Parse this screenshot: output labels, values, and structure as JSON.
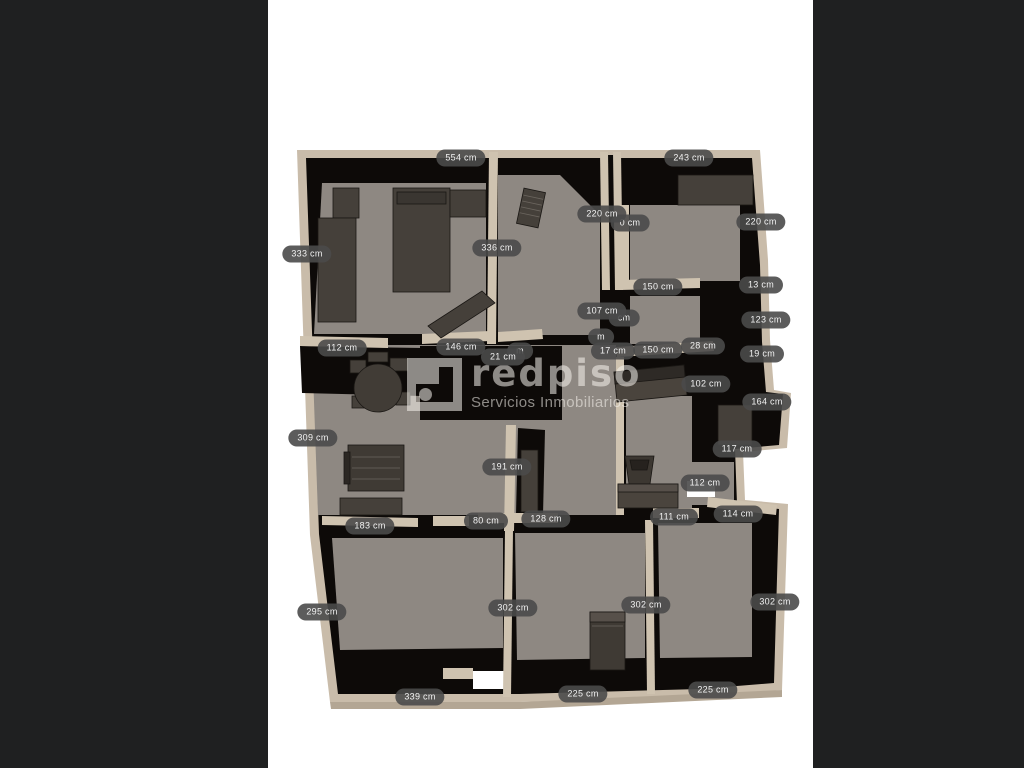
{
  "page": {
    "background_color": "#1f2021",
    "canvas_color": "#ffffff"
  },
  "watermark": {
    "brand": "redpiso",
    "tagline": "Servicios Inmobiliarios",
    "color": "rgba(248,244,238,0.55)",
    "icon": "redpiso-square-room-dot-logo"
  },
  "floorplan": {
    "type": "3d-floor-plan-top-view",
    "unit": "cm",
    "wall_color": "#c9bcaa",
    "inner_wall_color": "#cfc3b0",
    "floor_color": "#8e8882",
    "shadow_color": "#0d0a08",
    "furniture_color": "#45403a",
    "label_pill_color": "#4a4a4a",
    "label_text_color": "#f2f2f2",
    "labels": [
      {
        "text": "554 cm",
        "x": 461,
        "y": 158
      },
      {
        "text": "243 cm",
        "x": 689,
        "y": 158
      },
      {
        "text": "0 cm",
        "x": 630,
        "y": 223,
        "partial": true
      },
      {
        "text": "220 cm",
        "x": 602,
        "y": 214
      },
      {
        "text": "220 cm",
        "x": 761,
        "y": 222
      },
      {
        "text": "336 cm",
        "x": 497,
        "y": 248
      },
      {
        "text": "333 cm",
        "x": 307,
        "y": 254
      },
      {
        "text": "150 cm",
        "x": 658,
        "y": 287
      },
      {
        "text": "13 cm",
        "x": 761,
        "y": 285
      },
      {
        "text": "cm",
        "x": 624,
        "y": 318,
        "partial": true
      },
      {
        "text": "107 cm",
        "x": 602,
        "y": 311
      },
      {
        "text": "123 cm",
        "x": 766,
        "y": 320
      },
      {
        "text": "112 cm",
        "x": 342,
        "y": 348
      },
      {
        "text": "146 cm",
        "x": 461,
        "y": 347
      },
      {
        "text": "m",
        "x": 520,
        "y": 351,
        "partial": true
      },
      {
        "text": "21 cm",
        "x": 503,
        "y": 357
      },
      {
        "text": "m",
        "x": 601,
        "y": 337,
        "partial": true
      },
      {
        "text": "17 cm",
        "x": 613,
        "y": 351
      },
      {
        "text": "150 cm",
        "x": 658,
        "y": 350
      },
      {
        "text": "28 cm",
        "x": 703,
        "y": 346
      },
      {
        "text": "19 cm",
        "x": 762,
        "y": 354
      },
      {
        "text": "102 cm",
        "x": 706,
        "y": 384
      },
      {
        "text": "164 cm",
        "x": 767,
        "y": 402
      },
      {
        "text": "309 cm",
        "x": 313,
        "y": 438
      },
      {
        "text": "117 cm",
        "x": 737,
        "y": 449
      },
      {
        "text": "191 cm",
        "x": 507,
        "y": 467
      },
      {
        "text": "112 cm",
        "x": 705,
        "y": 483
      },
      {
        "text": "183 cm",
        "x": 370,
        "y": 526
      },
      {
        "text": "80 cm",
        "x": 486,
        "y": 521
      },
      {
        "text": "128 cm",
        "x": 546,
        "y": 519
      },
      {
        "text": "111 cm",
        "x": 674,
        "y": 517
      },
      {
        "text": "114 cm",
        "x": 738,
        "y": 514
      },
      {
        "text": "295 cm",
        "x": 322,
        "y": 612
      },
      {
        "text": "302 cm",
        "x": 513,
        "y": 608
      },
      {
        "text": "302 cm",
        "x": 646,
        "y": 605
      },
      {
        "text": "302 cm",
        "x": 775,
        "y": 602
      },
      {
        "text": "339 cm",
        "x": 420,
        "y": 697
      },
      {
        "text": "225 cm",
        "x": 583,
        "y": 694
      },
      {
        "text": "225 cm",
        "x": 713,
        "y": 690
      }
    ]
  }
}
